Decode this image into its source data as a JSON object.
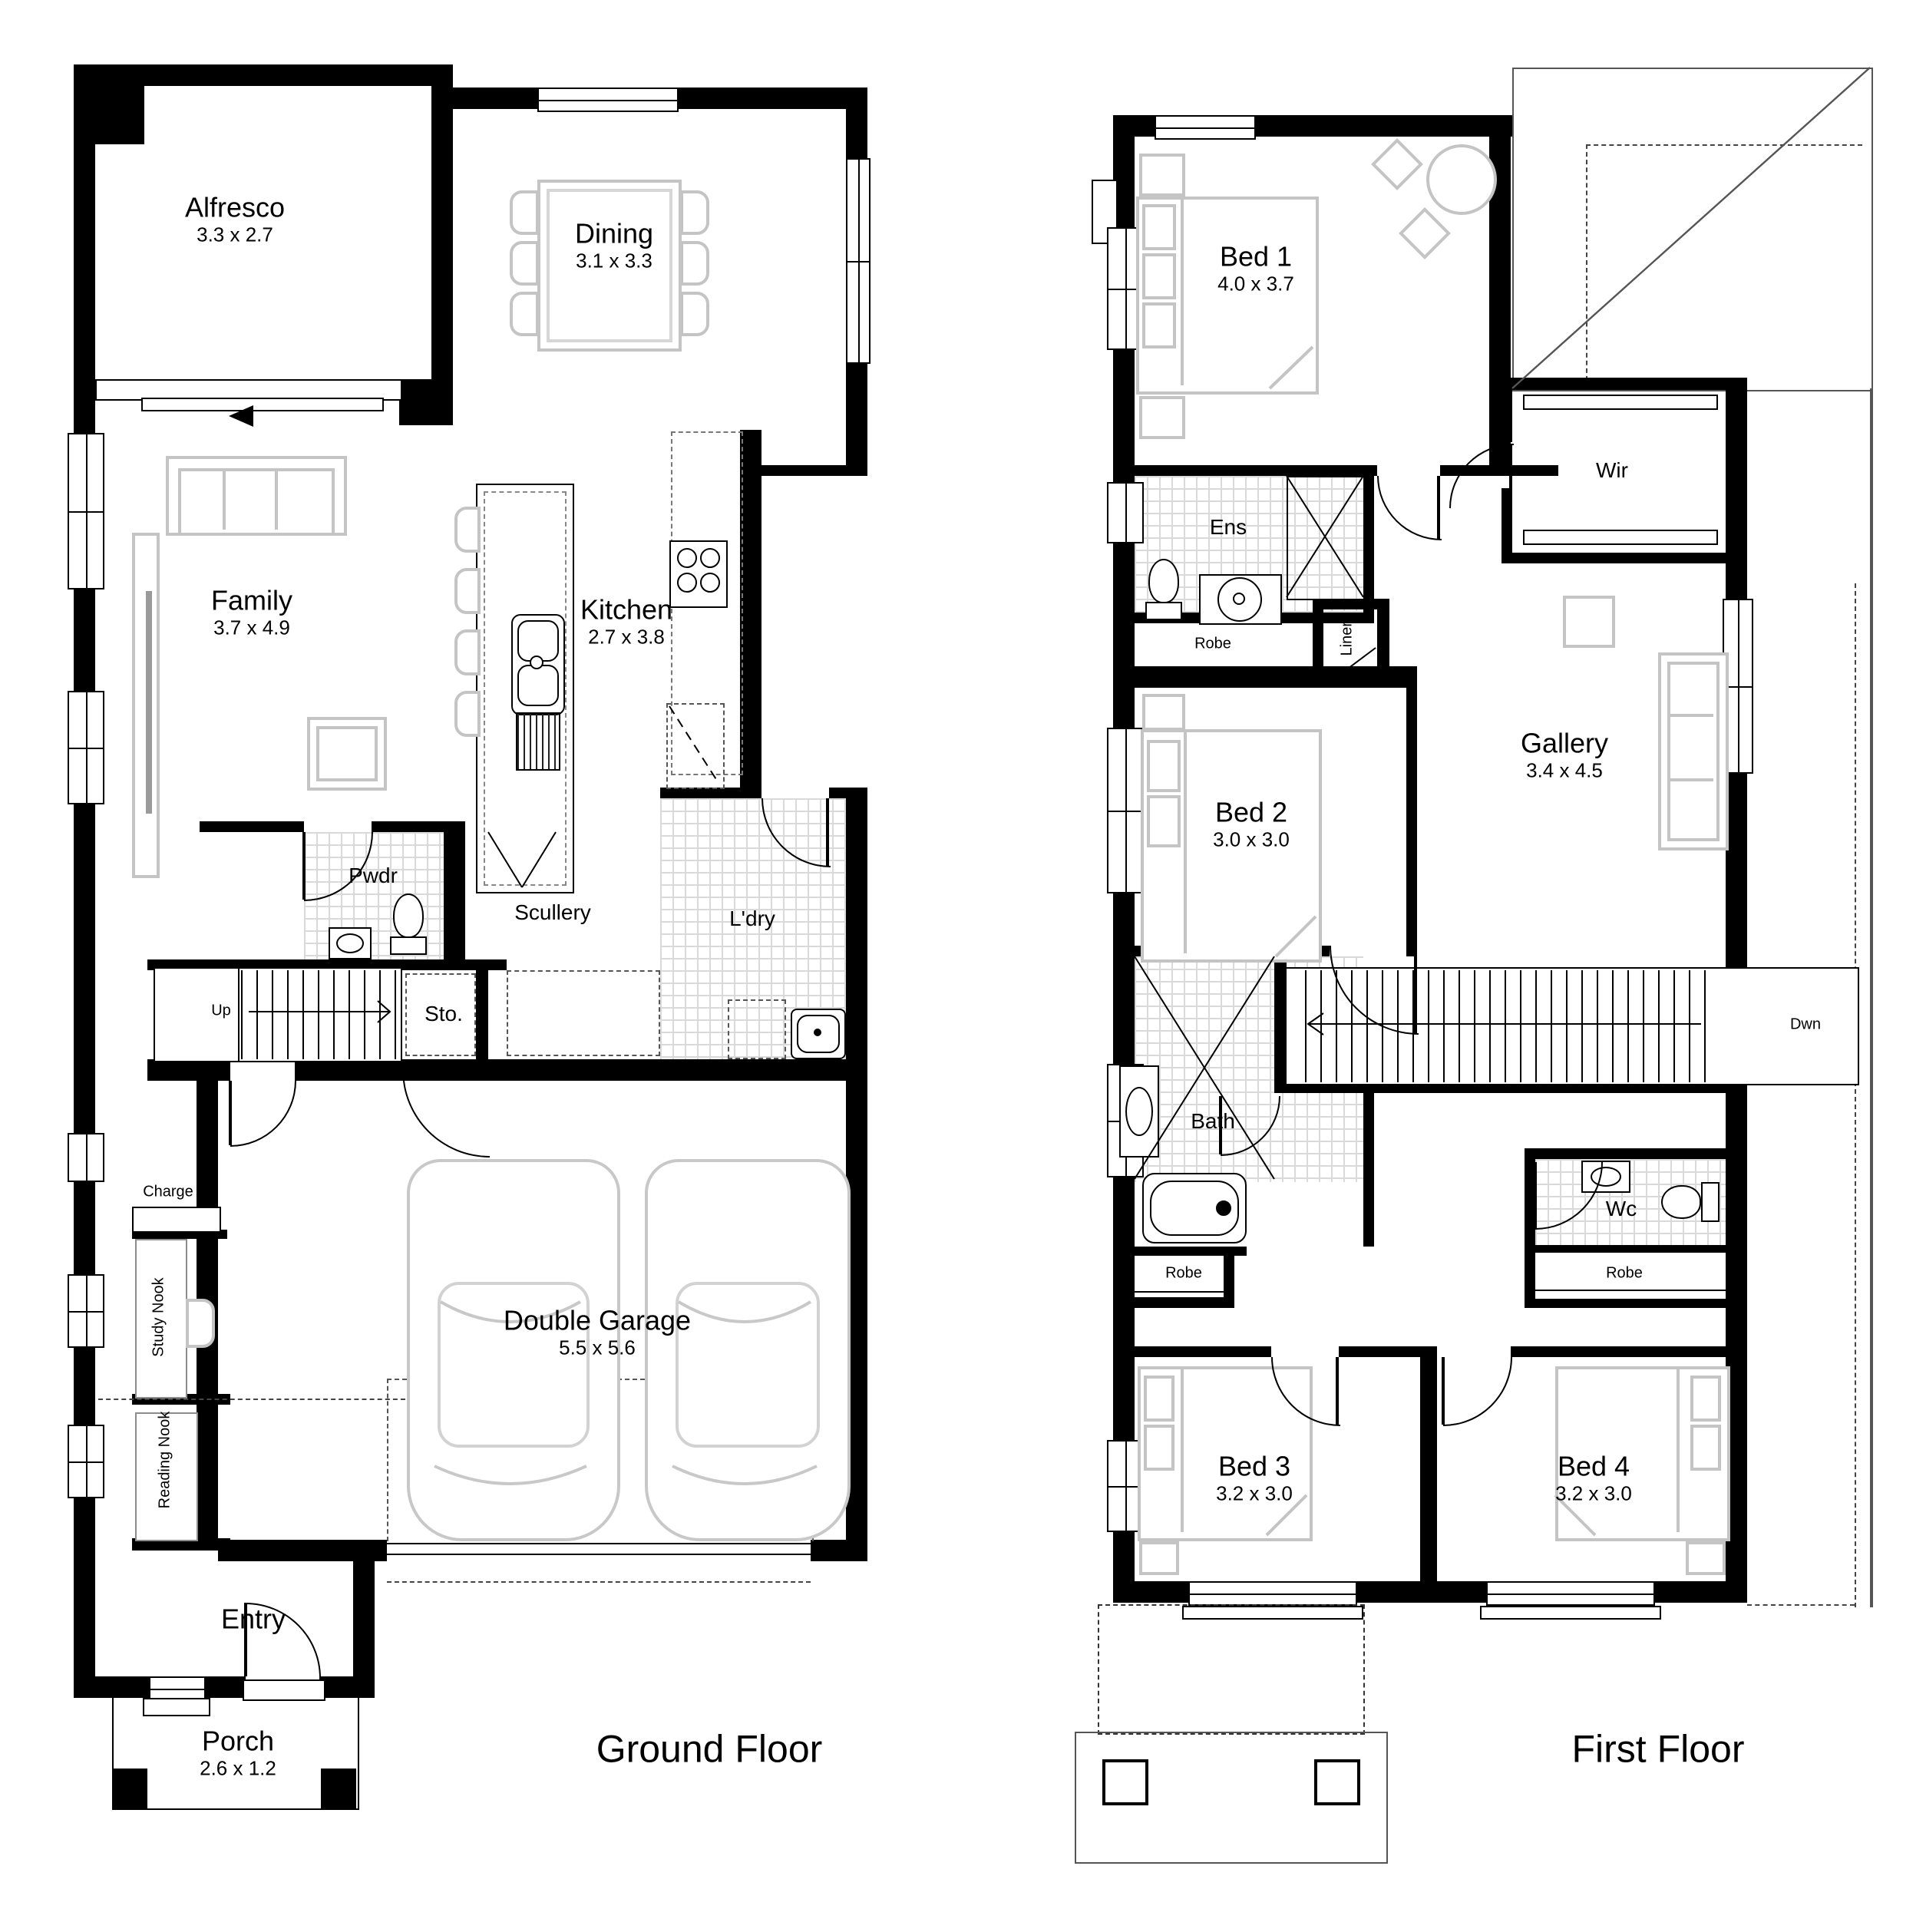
{
  "titles": {
    "ground": "Ground Floor",
    "first": "First Floor"
  },
  "ground": {
    "alfresco": {
      "name": "Alfresco",
      "size": "3.3 x 2.7"
    },
    "dining": {
      "name": "Dining",
      "size": "3.1 x 3.3"
    },
    "family": {
      "name": "Family",
      "size": "3.7 x 4.9"
    },
    "kitchen": {
      "name": "Kitchen",
      "size": "2.7 x 3.8"
    },
    "pwdr": {
      "name": "Pwdr"
    },
    "scullery": {
      "name": "Scullery"
    },
    "ldry": {
      "name": "L'dry"
    },
    "sto": {
      "name": "Sto."
    },
    "up": {
      "name": "Up"
    },
    "garage": {
      "name": "Double Garage",
      "size": "5.5 x 5.6"
    },
    "charge": {
      "name": "Charge St."
    },
    "study": {
      "name": "Study Nook"
    },
    "reading": {
      "name": "Reading Nook"
    },
    "entry": {
      "name": "Entry"
    },
    "porch": {
      "name": "Porch",
      "size": "2.6 x 1.2"
    }
  },
  "first": {
    "bed1": {
      "name": "Bed 1",
      "size": "4.0 x 3.7"
    },
    "wir": {
      "name": "Wir"
    },
    "ens": {
      "name": "Ens"
    },
    "robe1": {
      "name": "Robe"
    },
    "linen": {
      "name": "Linen"
    },
    "bed2": {
      "name": "Bed 2",
      "size": "3.0 x 3.0"
    },
    "gallery": {
      "name": "Gallery",
      "size": "3.4 x 4.5"
    },
    "dwn": {
      "name": "Dwn"
    },
    "bath": {
      "name": "Bath"
    },
    "wc": {
      "name": "Wc"
    },
    "robe3": {
      "name": "Robe"
    },
    "robe4": {
      "name": "Robe"
    },
    "bed3": {
      "name": "Bed 3",
      "size": "3.2 x 3.0"
    },
    "bed4": {
      "name": "Bed 4",
      "size": "3.2 x 3.0"
    }
  }
}
